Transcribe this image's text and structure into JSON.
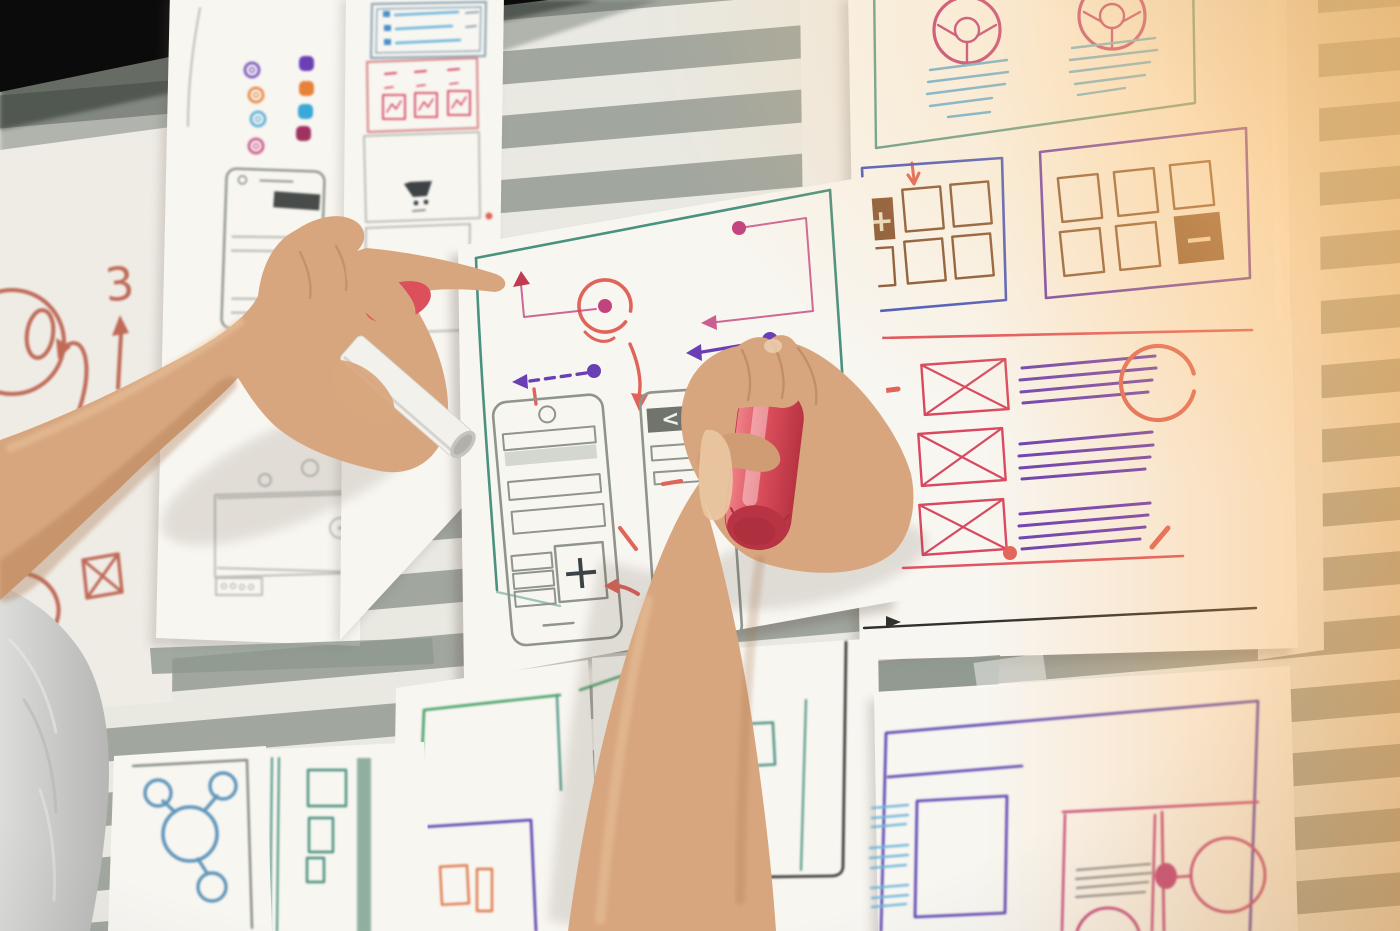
{
  "scene": {
    "setting": "office window covered by horizontal blinds, warm sunlight entering from the upper right",
    "subject": "two hands of a UX designer sketching mobile app wireframes with markers on white papers taped to the window",
    "held_items": [
      "white-marker",
      "red-marker"
    ]
  },
  "glyphs": {
    "plus": "+",
    "minus": "−",
    "three": "3",
    "chevron_left": "<"
  },
  "colors": {
    "stripe_light": "#e9e9e2",
    "stripe_dark": "#a1a69f",
    "gap_stripe": "#8f998f",
    "frame_black": "#0b0b0b",
    "paper": "#f8f6f1",
    "paper_dim": "#efece6",
    "paper_warm": "#f6efe4",
    "pencil": "#bcbeb7",
    "pencil_dark": "#8f948d",
    "ink_dark": "#3c4347",
    "box_blue": "#8fa8b8",
    "pink_soft": "#d98d8d",
    "teal": "#4a9180",
    "green": "#43a065",
    "blue": "#4a90c8",
    "light_blue": "#6db4da",
    "steel_blue": "#6096ba",
    "purple": "#6a3fb5",
    "violet": "#5a3fb0",
    "blue_violet": "#4a5ac0",
    "pink": "#c2447e",
    "dark_red": "#c03a50",
    "red": "#d84860",
    "coral": "#e0645a",
    "rust": "#c06a58",
    "red_line": "#e05560",
    "brown": "#8a5a3a",
    "cream": "#eadbc0",
    "gray_line": "#8a9096",
    "black_line": "#30302e",
    "skin": "#d8a67e",
    "skin_light": "#eac8a2",
    "skin_shadow": "#a9744e",
    "sleeve": "#cfcfcd",
    "sleeve_dark": "#b2b2b0",
    "marker_white": "#f2f1ec",
    "marker_white_cap": "#c6c4bf",
    "marker_red": "#dc4f5c",
    "marker_red_dark": "#b83343",
    "warm_glow": "#ffb45e"
  },
  "papers": [
    {
      "id": "paper-left-doodles",
      "content": "red doodles: zero dial, looping arrow, number 3 with up arrow, crossed box, loops"
    },
    {
      "id": "paper-icon-grid",
      "content": "two columns of colored app icons above a pencil phone wireframe and footer bars"
    },
    {
      "id": "paper-form",
      "content": "list box with blue rows, pink icon table, shopping-cart panel"
    },
    {
      "id": "paper-main-wireframe",
      "content": "green-bordered flow sketch: pink flow path and dots, red circled hotspot, purple arrows, dashed arrow, two phone wireframes with plus tile, red annotations"
    },
    {
      "id": "paper-donut-charts",
      "content": "two pink donut charts with blue text lines; blue and purple boxes holding brown thumbnail grids with plus and minus tiles"
    },
    {
      "id": "paper-image-list",
      "content": "three red crossed image placeholders with purple text lines and a red circle highlight"
    },
    {
      "id": "paper-node-diagram",
      "content": "blue cluster diagram of four linked circles in a gray frame"
    },
    {
      "id": "paper-vertical-list",
      "content": "teal vertical rules with small squares and a thick bar"
    },
    {
      "id": "paper-green-frame",
      "content": "green frame above a purple box with orange squares"
    },
    {
      "id": "paper-dark-frame",
      "content": "dark rounded frame with teal line and green blocks"
    },
    {
      "id": "paper-detail-layout",
      "content": "purple frame and square, blue line groups, pink split layout with circles and gray text lines"
    }
  ],
  "markers": {
    "white": {
      "body": "white barrel, gray end cap, held between fingers of the left hand"
    },
    "red": {
      "body": "coral-red barrel with rounded end, gripped by the right hand while drawing"
    }
  }
}
